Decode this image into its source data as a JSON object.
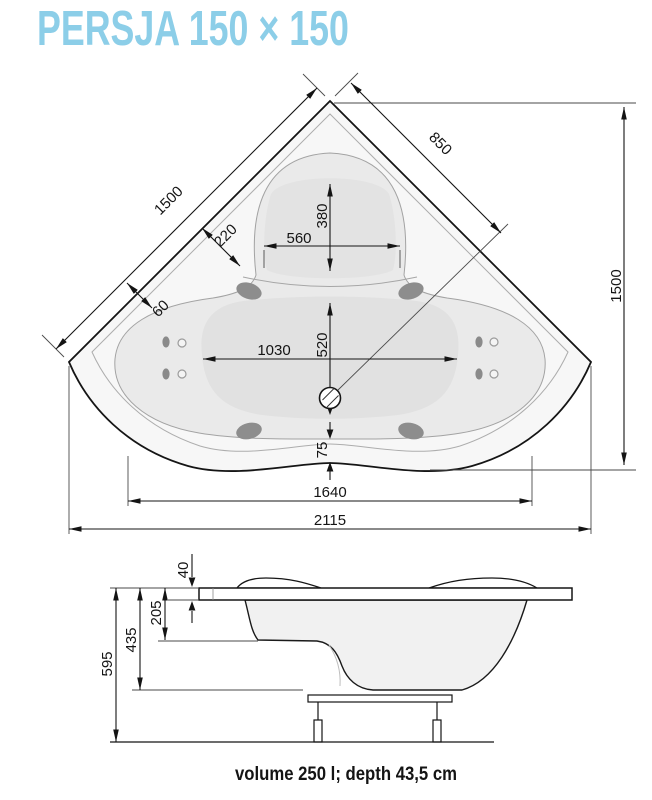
{
  "title": "PERSJA 150 × 150",
  "footer": "volume 250 l; depth 43,5 cm",
  "colors": {
    "title_accent": "#8ccee8",
    "line": "#141414",
    "contour": "#adadad",
    "shell_fill": "#f7f7f7",
    "deck_fill": "#f0f0f0",
    "basin_fill": "#eaeaea",
    "deep_fill": "#e1e1e1",
    "seat_fill": "#e3e3e3",
    "jet_fill": "#8d8d8d"
  },
  "top_view": {
    "dims": {
      "wall_left": "1500",
      "corner_to_drain": "850",
      "height_right": "1500",
      "rim_width": "220",
      "seat_width": "560",
      "seat_depth": "380",
      "edge_width": "60",
      "bowl_length": "1030",
      "seat_to_drain": "520",
      "front_apron": "75",
      "width_inner": "1640",
      "width_total": "2115"
    }
  },
  "side_view": {
    "dims": {
      "rim_thickness": "40",
      "rim_to_seat": "205",
      "shell_height": "435",
      "total_height": "595"
    }
  }
}
